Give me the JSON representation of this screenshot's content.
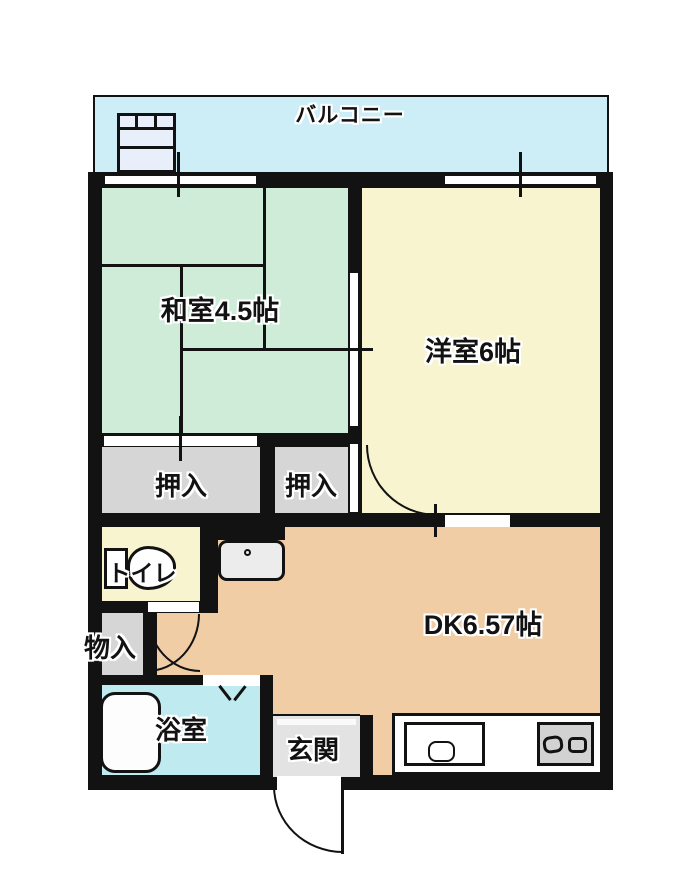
{
  "floorplan": {
    "type": "japanese-apartment-floor-plan",
    "balcony": {
      "label": "バルコニー"
    },
    "rooms": {
      "washitsu": {
        "label": "和室4.5帖"
      },
      "yoshitsu": {
        "label": "洋室6帖"
      },
      "dk": {
        "label": "DK6.57帖"
      },
      "closet_left": {
        "label": "押入"
      },
      "closet_right": {
        "label": "押入"
      },
      "toilet": {
        "label": "トイレ"
      },
      "storage": {
        "label": "物入"
      },
      "bath": {
        "label": "浴室"
      },
      "entrance": {
        "label": "玄関"
      }
    },
    "icons": {
      "washer_pan": "washer-pan-icon",
      "toilet": "toilet-icon",
      "washbasin": "washbasin-icon",
      "bathtub": "bathtub-icon",
      "kitchen_sink": "kitchen-sink-icon",
      "stove": "stove-icon",
      "door_arcs": "door-swing-arc",
      "folding_door": "folding-door-v-icon",
      "windows": "sliding-window"
    },
    "colors": {
      "wall": "#121212",
      "balcony": "#cdeef7",
      "washitsu": "#cfecd9",
      "yoshitsu": "#f8f4d0",
      "dk": "#f0cda4",
      "closet": "#d6d6d6",
      "toilet_room": "#f8f4d0",
      "bath": "#bfeaf0",
      "entrance": "#e3e3e3",
      "background": "#ffffff"
    }
  }
}
